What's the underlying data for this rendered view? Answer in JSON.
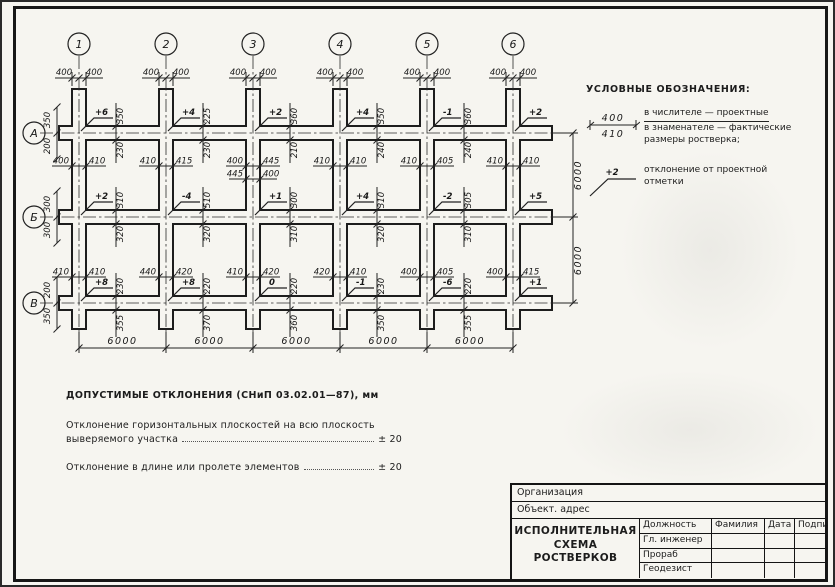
{
  "drawing": {
    "column_axes": [
      "1",
      "2",
      "3",
      "4",
      "5",
      "6"
    ],
    "row_axes": [
      "А",
      "Б",
      "В"
    ],
    "top_dims": {
      "left": "400",
      "right": "400"
    },
    "bottom_spans": [
      "6000",
      "6000",
      "6000",
      "6000",
      "6000"
    ],
    "right_spans": [
      "6000",
      "6000"
    ],
    "left_edge_dims": [
      {
        "above": "350",
        "below": "200"
      },
      {
        "above": "300",
        "below": "300"
      },
      {
        "above": "200",
        "below": "350"
      }
    ],
    "deviations": [
      [
        "+6",
        "+4",
        "+2",
        "+4",
        "-1",
        "+2"
      ],
      [
        "+2",
        "-4",
        "+1",
        "+4",
        "-2",
        "+5"
      ],
      [
        "+8",
        "+8",
        "0",
        "-1",
        "-6",
        "+1"
      ]
    ],
    "dim_pairs_ab": [
      [
        "400",
        "410"
      ],
      [
        "410",
        "415"
      ],
      [
        "400",
        "445"
      ],
      [
        "410",
        "410"
      ],
      [
        "410",
        "405"
      ],
      [
        "410",
        "410"
      ]
    ],
    "dim_pairs_ab_extra": {
      "col_index": 2,
      "pair": [
        "445",
        "400"
      ]
    },
    "dim_pairs_bv": [
      [
        "410",
        "410"
      ],
      [
        "440",
        "420"
      ],
      [
        "410",
        "420"
      ],
      [
        "420",
        "410"
      ],
      [
        "400",
        "405"
      ],
      [
        "400",
        "415"
      ]
    ],
    "gap_dims": {
      "row_a": [
        {
          "above": "350",
          "below": "230"
        },
        {
          "above": "225",
          "below": "230"
        },
        {
          "above": "360",
          "below": "210"
        },
        {
          "above": "350",
          "below": "240"
        },
        {
          "above": "360",
          "below": "240"
        }
      ],
      "row_b": [
        {
          "above": "310",
          "below": "320"
        },
        {
          "above": "510",
          "below": "320"
        },
        {
          "above": "300",
          "below": "310"
        },
        {
          "above": "310",
          "below": "320"
        },
        {
          "above": "305",
          "below": "310"
        }
      ],
      "row_v": [
        {
          "above": "230",
          "below": "355"
        },
        {
          "above": "220",
          "below": "370"
        },
        {
          "above": "220",
          "below": "360"
        },
        {
          "above": "230",
          "below": "350"
        },
        {
          "above": "220",
          "below": "355"
        }
      ]
    }
  },
  "legend": {
    "title": "УСЛОВНЫЕ ОБОЗНАЧЕНИЯ:",
    "size_symbol": {
      "top": "400",
      "bottom": "410"
    },
    "size_text_line1": "в числителе — проектные",
    "size_text_line2": "в знаменателе — фактические",
    "size_text_line3": "размеры ростверка;",
    "deviation_symbol": "+2",
    "deviation_text_line1": "отклонение от проектной",
    "deviation_text_line2": "отметки"
  },
  "notes": {
    "title": "ДОПУСТИМЫЕ ОТКЛОНЕНИЯ (СНиП 03.02.01—87), мм",
    "items": [
      {
        "line1": "Отклонение горизонтальных плоскостей на всю плоскость",
        "line2": "выверяемого участка",
        "value": "± 20"
      },
      {
        "line1": "",
        "line2": "Отклонение в длине или пролете элементов",
        "value": "± 20"
      }
    ]
  },
  "title_block": {
    "organization_label": "Организация",
    "object_label": "Объект. адрес",
    "drawing_title": "ИСПОЛНИТЕЛЬНАЯ СХЕМА РОСТВЕРКОВ",
    "columns": [
      "Должность",
      "Фамилия",
      "Дата",
      "Подпись"
    ],
    "rows": [
      "Гл. инженер",
      "Прораб",
      "Геодезист"
    ]
  },
  "colors": {
    "ink": "#1d1d1d",
    "paper": "#f6f5f0"
  }
}
